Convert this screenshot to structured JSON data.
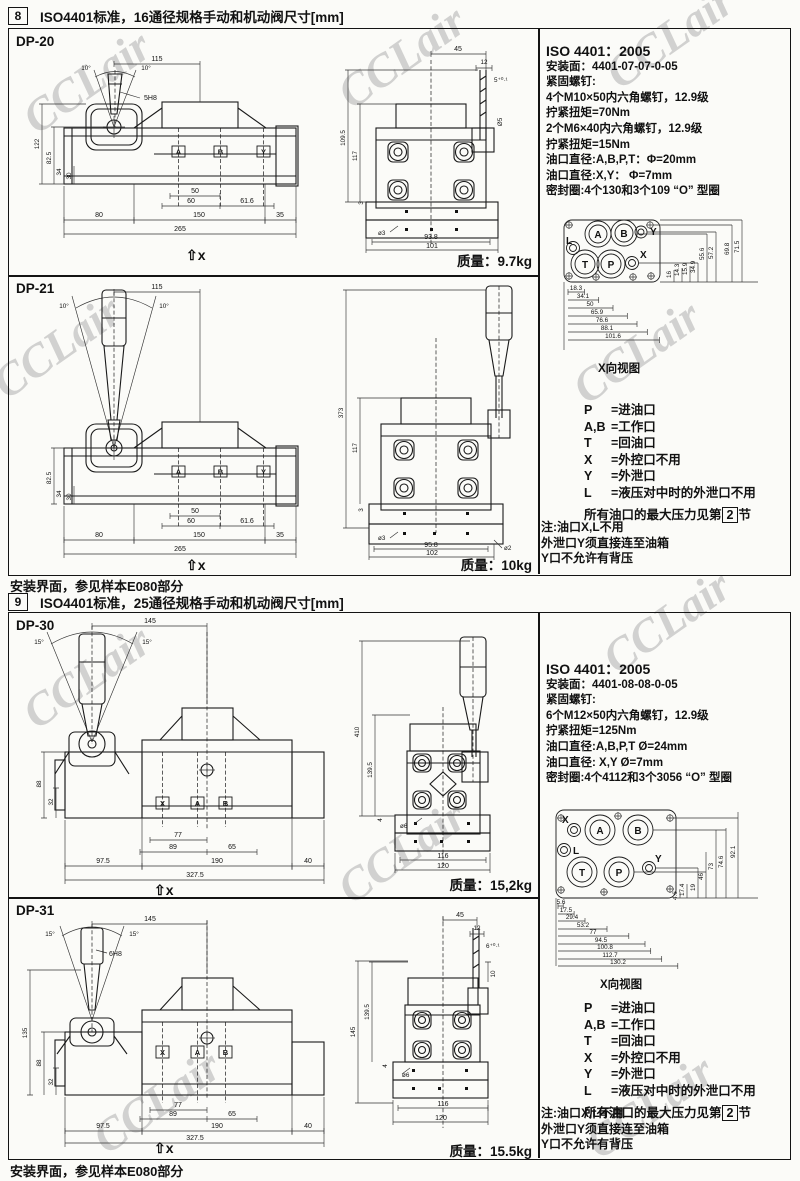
{
  "watermark": "CCLair",
  "headers": {
    "s8_num": "8",
    "s8_title": "ISO4401标准，16通径规格手动和机动阀尺寸[mm]",
    "s9_num": "9",
    "s9_title": "ISO4401标准，25通径规格手动和机动阀尺寸[mm]",
    "footer": "安装界面，参见样本E080部分"
  },
  "mass_label": "质量：",
  "legend": {
    "rows": [
      {
        "k": "P",
        "v": "=进油口"
      },
      {
        "k": "A,B",
        "v": "=工作口"
      },
      {
        "k": "T",
        "v": "=回油口"
      },
      {
        "k": "X",
        "v": "=外控口不用"
      },
      {
        "k": "Y",
        "v": "=外泄口"
      },
      {
        "k": "L",
        "v": "=液压对中时的外泄口不用"
      }
    ],
    "max_pre": "所有油口的最大压力见第",
    "max_num": "2",
    "max_post": "节"
  },
  "note": {
    "l1": "注:油口X,L不用",
    "l2": "外泄口Y须直接连至油箱",
    "l3": "Y口不允许有背压"
  },
  "s8_info": {
    "l1": "ISO 4401：2005",
    "l2": "安装面：4401-07-07-0-05",
    "l3": "紧固螺钉:",
    "l4": "4个M10×50内六角螺钉，12.9级",
    "l5": "拧紧扭矩=70Nm",
    "l6": "2个M6×40内六角螺钉，12.9级",
    "l7": "拧紧扭矩=15Nm",
    "l8": "油口直径:A,B,P,T：Φ=20mm",
    "l9": "油口直径:X,Y： Φ=7mm",
    "l10": "密封圈:4个130和3个109 “O” 型圈"
  },
  "s9_info": {
    "l1": "ISO 4401：2005",
    "l2": "安装面：4401-08-08-0-05",
    "l3": "紧固螺钉:",
    "l4": "6个M12×50内六角螺钉，12.9级",
    "l5": "拧紧扭矩=125Nm",
    "l6": "油口直径:A,B,P,T Ø=24mm",
    "l7": "油口直径: X,Y Ø=7mm",
    "l8": "密封圈:4个4112和3个3056 “O” 型圈"
  },
  "face8": {
    "caption": "X向视图",
    "pL": "L",
    "pA": "A",
    "pB": "B",
    "pY": "Y",
    "pT": "T",
    "pP": "P",
    "pX": "X",
    "b1": "18.3",
    "b2": "34.1",
    "b3": "50",
    "b4": "65.9",
    "b5": "76.6",
    "b6": "88.1",
    "b7": "101.6",
    "r1": "34.9",
    "r2": "55.6",
    "r3": "57.2",
    "r4": "69.8",
    "r5": "71.5",
    "s1": "16",
    "s2": "14.3",
    "s3": "15.9"
  },
  "face9": {
    "caption": "X向视图",
    "pL": "L",
    "pA": "A",
    "pB": "B",
    "pY": "Y",
    "pT": "T",
    "pP": "P",
    "pX": "X",
    "b1": "5.6",
    "b2": "17.5",
    "b3": "29.4",
    "b4": "53.2",
    "b5": "77",
    "b6": "94.5",
    "b7": "100.8",
    "b8": "112.7",
    "b9": "130.2",
    "r1": "19",
    "r2": "46",
    "r3": "73",
    "r4": "74.6",
    "r5": "92.1",
    "s1": "4.6",
    "s2": "17.4"
  },
  "dp20": {
    "name": "DP-20",
    "mass": "9.7kg",
    "f": {
      "w115": "115",
      "ang1": "10°",
      "ang2": "10°",
      "pin": "5H8",
      "v122": "122",
      "v825": "82.5",
      "v34": "34",
      "v30": "30",
      "b50": "50",
      "b60": "60",
      "b616": "61.6",
      "r80": "80",
      "r150": "150",
      "r35": "35",
      "total": "265",
      "pA": "A",
      "pB": "B",
      "pY": "Y",
      "xdir": "⇧x"
    },
    "s": {
      "t45": "45",
      "t12": "12",
      "t5": "5⁺⁰·¹",
      "stem": "Ø5",
      "v1095": "109.5",
      "v117": "117",
      "v3": "3",
      "hole": "ø3",
      "b938": "93.8",
      "b101": "101"
    }
  },
  "dp21": {
    "name": "DP-21",
    "mass": "10kg",
    "f": {
      "w115": "115",
      "ang1": "10°",
      "ang2": "10°",
      "v825": "82.5",
      "v34": "34",
      "v30": "30",
      "b50": "50",
      "b60": "60",
      "b616": "61.6",
      "r80": "80",
      "r150": "150",
      "r35": "35",
      "total": "265",
      "pA": "A",
      "pB": "B",
      "pY": "Y",
      "xdir": "⇧x"
    },
    "s": {
      "v373": "373",
      "v117": "117",
      "v3": "3",
      "hole": "ø3",
      "b958": "95.8",
      "hole2": "ø2",
      "b102": "102"
    }
  },
  "dp30": {
    "name": "DP-30",
    "mass": "15,2kg",
    "f": {
      "w145": "145",
      "ang1": "15°",
      "ang2": "15°",
      "v88": "88",
      "v32": "32",
      "b77": "77",
      "b89": "89",
      "b65": "65",
      "r975": "97.5",
      "r190": "190",
      "r40": "40",
      "total": "327.5",
      "pX": "X",
      "pA": "A",
      "pB": "B",
      "xdir": "⇧x"
    },
    "s": {
      "v410": "410",
      "v1395": "139.5",
      "v4": "4",
      "hole": "ø6",
      "b116": "116",
      "b120": "120"
    }
  },
  "dp31": {
    "name": "DP-31",
    "mass": "15.5kg",
    "f": {
      "w145": "145",
      "ang1": "15°",
      "ang2": "15°",
      "pin": "6H8",
      "v135": "135",
      "v88": "88",
      "v32": "32",
      "b77": "77",
      "b89": "89",
      "b65": "65",
      "r975": "97.5",
      "r190": "190",
      "r40": "40",
      "total": "327.5",
      "pX": "X",
      "pA": "A",
      "pB": "B",
      "xdir": "⇧x"
    },
    "s": {
      "t45": "45",
      "t12": "12",
      "t6": "6⁺⁰·¹",
      "t10": "10",
      "v145": "145",
      "v1395": "139.5",
      "v4": "4",
      "hole": "ø6",
      "b116": "116",
      "b120": "120"
    }
  }
}
